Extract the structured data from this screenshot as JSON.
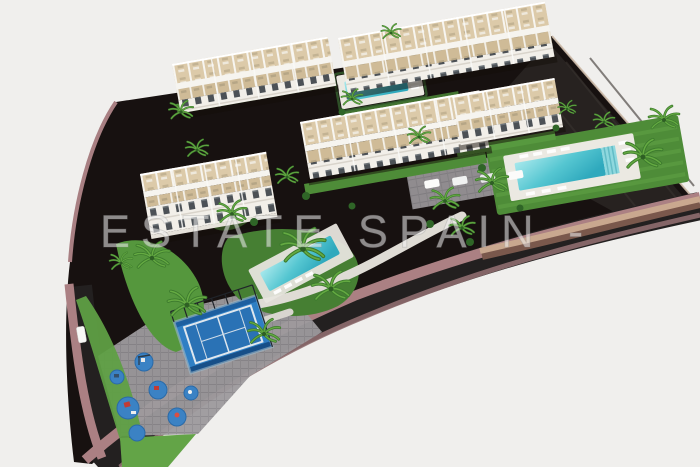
{
  "image": {
    "type": "3d-architectural-render",
    "view": "aerial-isometric",
    "description": "Bird's-eye 3D render of a new-build residential complex: five white apartment blocks with beige roof terraces and pergolas, three turquoise communal swimming pools with sun loungers, a blue paddle tennis court, a children's playground with blue safety circles, palm-tree gardens and lawns, all enclosed by a dark curved perimeter road with mauve sidewalks on a white background."
  },
  "watermark": {
    "text": "ESTATE SPAIN -",
    "color": "#f0f0f0",
    "opacity": 0.55
  },
  "scene": {
    "background_color": "#f0efed",
    "colors": {
      "ground": "#171110",
      "embankment": "#272220",
      "asphalt": "#232020",
      "sidewalk": "#ab8083",
      "curb": "#8f6d6f",
      "wall_brown": "#7a584c",
      "wall_cap": "#c9a88f",
      "lawn": "#4e8c38",
      "lawn_light": "#63a447",
      "pool_light": "#a7e8ec",
      "pool_deep": "#2fa9bd",
      "pool_deck": "#ebe9e2",
      "building_white": "#f4f2ed",
      "terrace_tan": "#dccaa9",
      "window_dark": "#4c5156",
      "paving": "#9d9a9d",
      "court_blue": "#2f7fc4",
      "court_wall": "#1d5fa0",
      "playpad_blue": "#3b82c4",
      "palm_green": "#3c7a2d",
      "palm_light": "#65aa42"
    },
    "counts": {
      "apartment_blocks": 5,
      "swimming_pools": 3,
      "paddle_courts": 1,
      "playgrounds": 1
    },
    "features": [
      "apartment blocks with roof terraces",
      "communal swimming pools with sun loungers",
      "paddle tennis court",
      "children's playground",
      "palm tree landscaping",
      "curved perimeter road with sidewalks"
    ]
  }
}
